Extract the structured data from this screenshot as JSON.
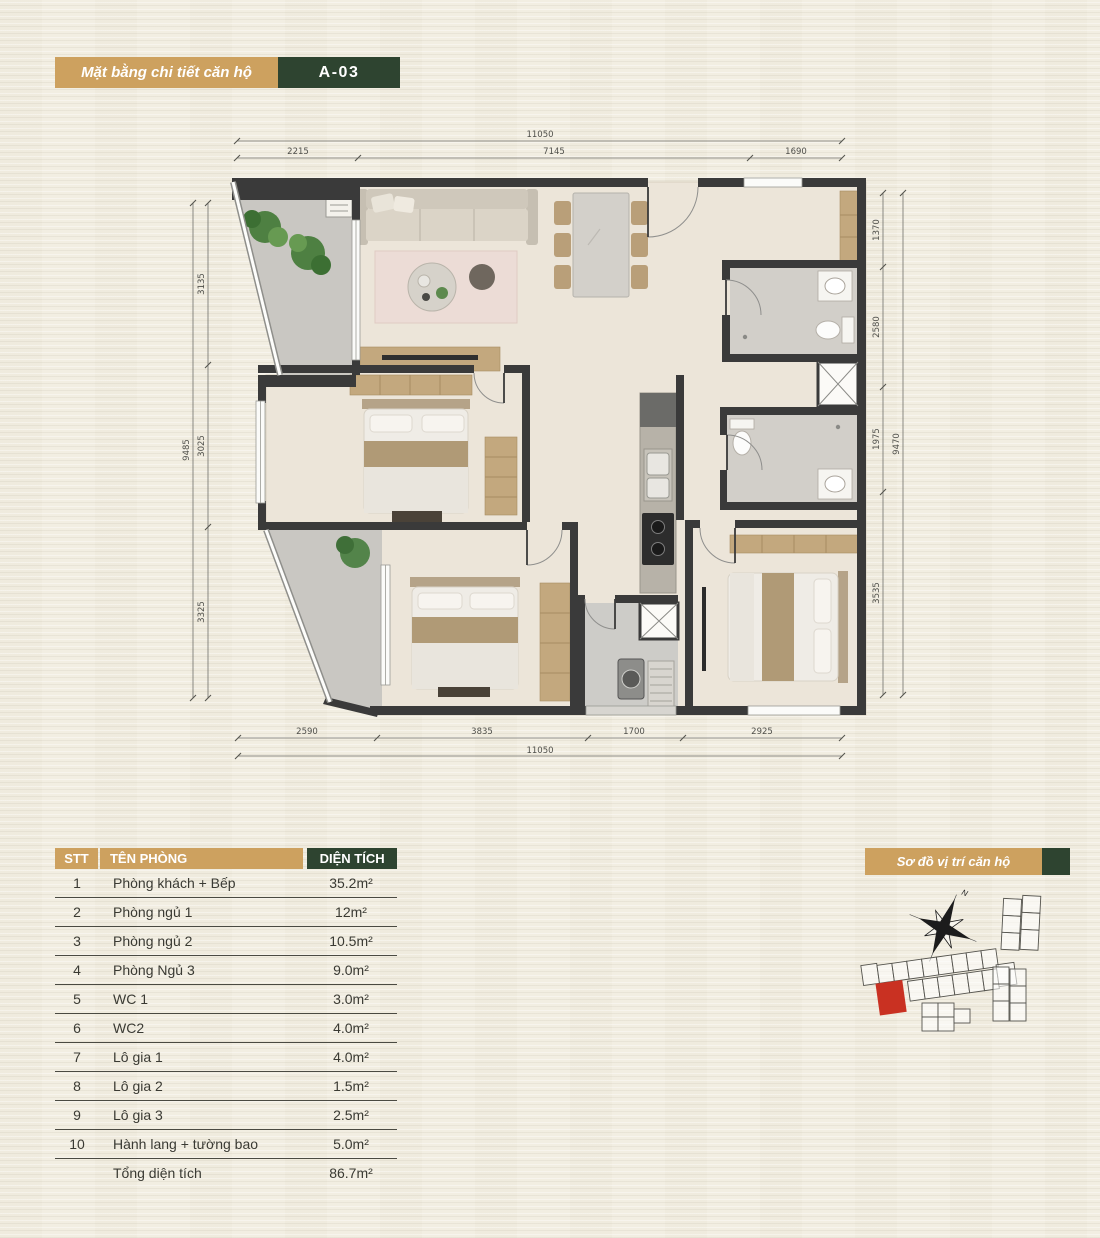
{
  "header": {
    "title": "Mặt bằng chi tiết căn hộ",
    "unit_code": "A-03"
  },
  "floor_plan": {
    "dim_top_total": "11050",
    "dim_top": [
      "2215",
      "7145",
      "1690"
    ],
    "dim_bottom": [
      "2590",
      "3835",
      "1700",
      "2925"
    ],
    "dim_bottom_total": "11050",
    "dim_left": [
      "3135",
      "3025",
      "3325"
    ],
    "dim_left_total": "9485",
    "dim_right": [
      "1370",
      "2580",
      "1975",
      "3535"
    ],
    "dim_right_total": "9470",
    "compass_label": "N"
  },
  "room_table": {
    "headers": {
      "no": "STT",
      "name": "TÊN PHÒNG",
      "area": "DIỆN TÍCH"
    },
    "rows": [
      {
        "no": "1",
        "name": "Phòng khách + Bếp",
        "area": "35.2m²"
      },
      {
        "no": "2",
        "name": "Phòng ngủ 1",
        "area": "12m²"
      },
      {
        "no": "3",
        "name": "Phòng ngủ 2",
        "area": "10.5m²"
      },
      {
        "no": "4",
        "name": "Phòng Ngủ 3",
        "area": "9.0m²"
      },
      {
        "no": "5",
        "name": "WC 1",
        "area": "3.0m²"
      },
      {
        "no": "6",
        "name": "WC2",
        "area": "4.0m²"
      },
      {
        "no": "7",
        "name": "Lô gia 1",
        "area": "4.0m²"
      },
      {
        "no": "8",
        "name": "Lô gia 2",
        "area": "1.5m²"
      },
      {
        "no": "9",
        "name": "Lô gia 3",
        "area": "2.5m²"
      },
      {
        "no": "10",
        "name": "Hành lang + tường bao",
        "area": "5.0m²"
      }
    ],
    "total": {
      "label": "Tổng diện tích",
      "area": "86.7m²"
    }
  },
  "site_map": {
    "title": "Sơ đồ vị trí căn hộ",
    "compass_label": "N"
  },
  "colors": {
    "accent_tan": "#cda15f",
    "accent_green": "#2e4430",
    "unit_highlight_red": "#c93122"
  }
}
